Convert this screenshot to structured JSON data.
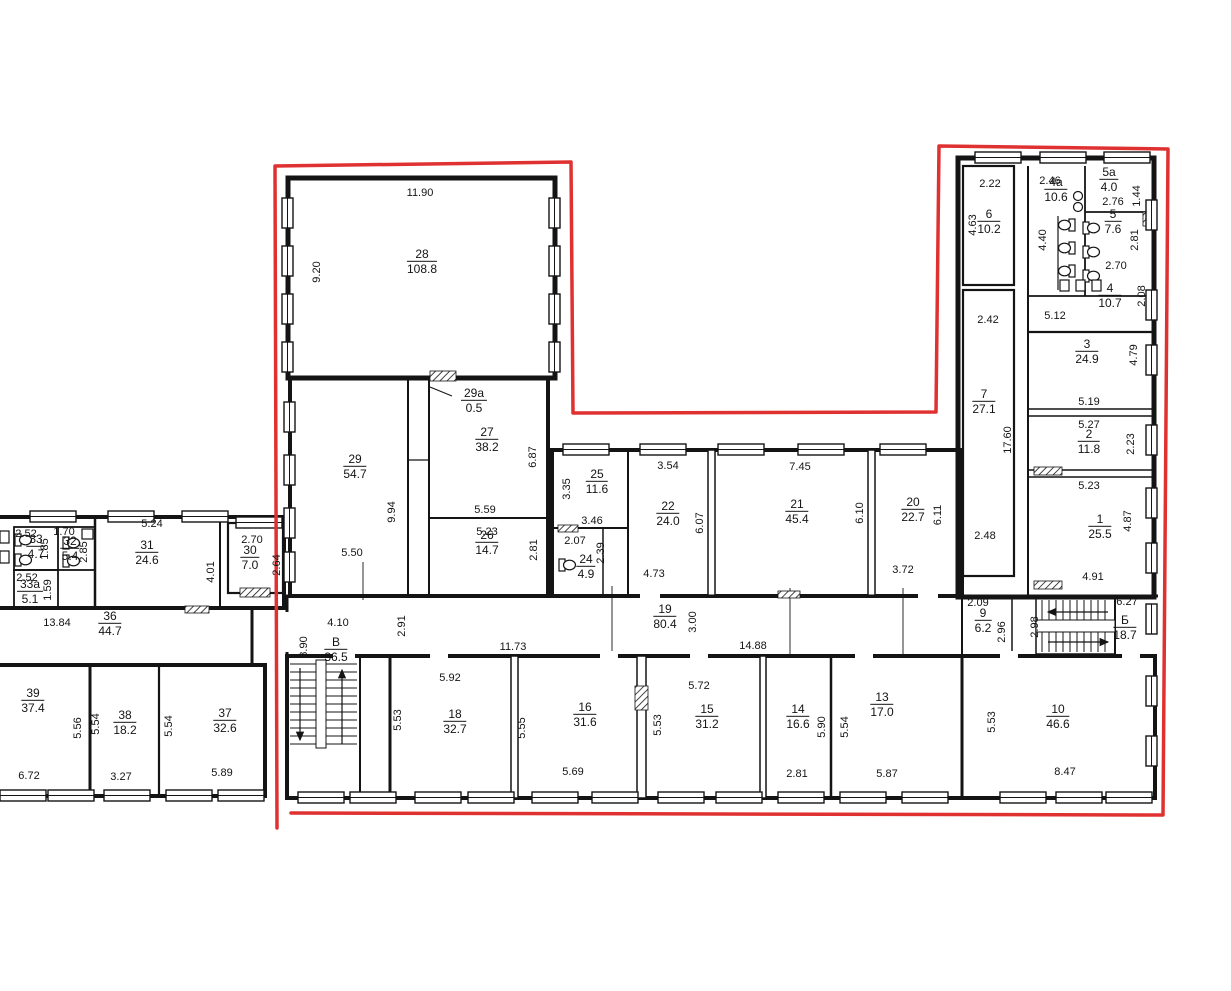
{
  "colors": {
    "outline": "#e03131",
    "wall": "#141414"
  },
  "rooms": [
    {
      "number": "28",
      "area": "108.8",
      "cx": 422,
      "cy": 262
    },
    {
      "number": "29a",
      "area": "0.5",
      "cx": 474,
      "cy": 401
    },
    {
      "number": "29",
      "area": "54.7",
      "cx": 355,
      "cy": 467
    },
    {
      "number": "27",
      "area": "38.2",
      "cx": 487,
      "cy": 440
    },
    {
      "number": "26",
      "area": "14.7",
      "cx": 487,
      "cy": 543
    },
    {
      "number": "25",
      "area": "11.6",
      "cx": 597,
      "cy": 482
    },
    {
      "number": "24",
      "area": "4.9",
      "cx": 586,
      "cy": 567
    },
    {
      "number": "22",
      "area": "24.0",
      "cx": 668,
      "cy": 514
    },
    {
      "number": "21",
      "area": "45.4",
      "cx": 797,
      "cy": 512
    },
    {
      "number": "20",
      "area": "22.7",
      "cx": 913,
      "cy": 510
    },
    {
      "number": "6",
      "area": "10.2",
      "cx": 989,
      "cy": 222
    },
    {
      "number": "4a",
      "area": "10.6",
      "cx": 1056,
      "cy": 190
    },
    {
      "number": "5a",
      "area": "4.0",
      "cx": 1109,
      "cy": 180
    },
    {
      "number": "5",
      "area": "7.6",
      "cx": 1113,
      "cy": 222
    },
    {
      "number": "4",
      "area": "10.7",
      "cx": 1110,
      "cy": 296
    },
    {
      "number": "7",
      "area": "27.1",
      "cx": 984,
      "cy": 402
    },
    {
      "number": "3",
      "area": "24.9",
      "cx": 1087,
      "cy": 352
    },
    {
      "number": "2",
      "area": "11.8",
      "cx": 1089,
      "cy": 442
    },
    {
      "number": "1",
      "area": "25.5",
      "cx": 1100,
      "cy": 527
    },
    {
      "number": "31",
      "area": "24.6",
      "cx": 147,
      "cy": 553
    },
    {
      "number": "30",
      "area": "7.0",
      "cx": 250,
      "cy": 558
    },
    {
      "number": "33",
      "area": "4.7",
      "cx": 36,
      "cy": 547
    },
    {
      "number": "32",
      "area": "5.4",
      "cx": 70,
      "cy": 549
    },
    {
      "number": "33a",
      "area": "5.1",
      "cx": 30,
      "cy": 592
    },
    {
      "number": "36",
      "area": "44.7",
      "cx": 110,
      "cy": 624
    },
    {
      "number": "39",
      "area": "37.4",
      "cx": 33,
      "cy": 701
    },
    {
      "number": "38",
      "area": "18.2",
      "cx": 125,
      "cy": 723
    },
    {
      "number": "37",
      "area": "32.6",
      "cx": 225,
      "cy": 721
    },
    {
      "number": "В",
      "area": "36.5",
      "cx": 336,
      "cy": 650
    },
    {
      "number": "19",
      "area": "80.4",
      "cx": 665,
      "cy": 617
    },
    {
      "number": "9",
      "area": "6.2",
      "cx": 983,
      "cy": 621
    },
    {
      "number": "Б",
      "area": "18.7",
      "cx": 1125,
      "cy": 628
    },
    {
      "number": "18",
      "area": "32.7",
      "cx": 455,
      "cy": 722
    },
    {
      "number": "16",
      "area": "31.6",
      "cx": 585,
      "cy": 715
    },
    {
      "number": "15",
      "area": "31.2",
      "cx": 707,
      "cy": 717
    },
    {
      "number": "14",
      "area": "16.6",
      "cx": 798,
      "cy": 717
    },
    {
      "number": "13",
      "area": "17.0",
      "cx": 882,
      "cy": 705
    },
    {
      "number": "10",
      "area": "46.6",
      "cx": 1058,
      "cy": 717
    }
  ],
  "dimensions": [
    {
      "text": "11.90",
      "cx": 420,
      "cy": 193
    },
    {
      "text": "9.20",
      "cx": 317,
      "cy": 272,
      "v": true
    },
    {
      "text": "9.94",
      "cx": 392,
      "cy": 512,
      "v": true
    },
    {
      "text": "5.50",
      "cx": 352,
      "cy": 553
    },
    {
      "text": "6.87",
      "cx": 533,
      "cy": 457,
      "v": true
    },
    {
      "text": "5.59",
      "cx": 485,
      "cy": 510
    },
    {
      "text": "5.23",
      "cx": 487,
      "cy": 532
    },
    {
      "text": "2.81",
      "cx": 534,
      "cy": 550,
      "v": true
    },
    {
      "text": "3.35",
      "cx": 567,
      "cy": 489,
      "v": true
    },
    {
      "text": "3.46",
      "cx": 592,
      "cy": 521
    },
    {
      "text": "2.07",
      "cx": 575,
      "cy": 541
    },
    {
      "text": "2.39",
      "cx": 601,
      "cy": 553,
      "v": true
    },
    {
      "text": "3.54",
      "cx": 668,
      "cy": 466
    },
    {
      "text": "6.07",
      "cx": 700,
      "cy": 523,
      "v": true
    },
    {
      "text": "4.73",
      "cx": 654,
      "cy": 574
    },
    {
      "text": "7.45",
      "cx": 800,
      "cy": 467
    },
    {
      "text": "6.10",
      "cx": 860,
      "cy": 513,
      "v": true
    },
    {
      "text": "6.11",
      "cx": 938,
      "cy": 515,
      "v": true
    },
    {
      "text": "3.72",
      "cx": 903,
      "cy": 570
    },
    {
      "text": "2.22",
      "cx": 990,
      "cy": 184
    },
    {
      "text": "4.63",
      "cx": 973,
      "cy": 225,
      "v": true
    },
    {
      "text": "2.46",
      "cx": 1050,
      "cy": 181
    },
    {
      "text": "4.40",
      "cx": 1043,
      "cy": 240,
      "v": true
    },
    {
      "text": "2.76",
      "cx": 1113,
      "cy": 202
    },
    {
      "text": "1.44",
      "cx": 1137,
      "cy": 196,
      "v": true
    },
    {
      "text": "2.81",
      "cx": 1135,
      "cy": 240,
      "v": true
    },
    {
      "text": "2.70",
      "cx": 1116,
      "cy": 266
    },
    {
      "text": "5.12",
      "cx": 1055,
      "cy": 316
    },
    {
      "text": "2.08",
      "cx": 1142,
      "cy": 296,
      "v": true
    },
    {
      "text": "2.42",
      "cx": 988,
      "cy": 320
    },
    {
      "text": "17.60",
      "cx": 1008,
      "cy": 440,
      "v": true
    },
    {
      "text": "2.48",
      "cx": 985,
      "cy": 536
    },
    {
      "text": "4.79",
      "cx": 1134,
      "cy": 355,
      "v": true
    },
    {
      "text": "5.19",
      "cx": 1089,
      "cy": 402
    },
    {
      "text": "5.27",
      "cx": 1089,
      "cy": 425
    },
    {
      "text": "2.23",
      "cx": 1131,
      "cy": 444,
      "v": true
    },
    {
      "text": "5.23",
      "cx": 1089,
      "cy": 486
    },
    {
      "text": "4.87",
      "cx": 1128,
      "cy": 521,
      "v": true
    },
    {
      "text": "4.91",
      "cx": 1093,
      "cy": 577
    },
    {
      "text": "5.24",
      "cx": 152,
      "cy": 524
    },
    {
      "text": "4.01",
      "cx": 211,
      "cy": 572,
      "v": true
    },
    {
      "text": "2.70",
      "cx": 252,
      "cy": 540
    },
    {
      "text": "2.64",
      "cx": 277,
      "cy": 565,
      "v": true
    },
    {
      "text": "2.52",
      "cx": 26,
      "cy": 534
    },
    {
      "text": "1.85",
      "cx": 45,
      "cy": 549,
      "v": true
    },
    {
      "text": "1.70",
      "cx": 64,
      "cy": 532
    },
    {
      "text": "2.85",
      "cx": 84,
      "cy": 552,
      "v": true
    },
    {
      "text": "2.52",
      "cx": 27,
      "cy": 578
    },
    {
      "text": "1.59",
      "cx": 48,
      "cy": 590,
      "v": true
    },
    {
      "text": "13.84",
      "cx": 57,
      "cy": 623
    },
    {
      "text": "5.56",
      "cx": 78,
      "cy": 728,
      "v": true
    },
    {
      "text": "6.72",
      "cx": 29,
      "cy": 776
    },
    {
      "text": "5.54",
      "cx": 96,
      "cy": 724,
      "v": true
    },
    {
      "text": "3.27",
      "cx": 121,
      "cy": 777
    },
    {
      "text": "5.54",
      "cx": 169,
      "cy": 726,
      "v": true
    },
    {
      "text": "5.89",
      "cx": 222,
      "cy": 773
    },
    {
      "text": "4.10",
      "cx": 338,
      "cy": 623
    },
    {
      "text": "8.90",
      "cx": 304,
      "cy": 647,
      "v": true
    },
    {
      "text": "2.91",
      "cx": 402,
      "cy": 626,
      "v": true
    },
    {
      "text": "11.73",
      "cx": 513,
      "cy": 647
    },
    {
      "text": "3.00",
      "cx": 693,
      "cy": 622,
      "v": true
    },
    {
      "text": "5.92",
      "cx": 450,
      "cy": 678
    },
    {
      "text": "5.53",
      "cx": 398,
      "cy": 720,
      "v": true
    },
    {
      "text": "5.55",
      "cx": 522,
      "cy": 728,
      "v": true
    },
    {
      "text": "5.69",
      "cx": 573,
      "cy": 772
    },
    {
      "text": "14.88",
      "cx": 753,
      "cy": 646
    },
    {
      "text": "5.72",
      "cx": 699,
      "cy": 686
    },
    {
      "text": "5.53",
      "cx": 658,
      "cy": 725,
      "v": true
    },
    {
      "text": "5.90",
      "cx": 822,
      "cy": 727,
      "v": true
    },
    {
      "text": "2.81",
      "cx": 797,
      "cy": 774
    },
    {
      "text": "5.54",
      "cx": 845,
      "cy": 727,
      "v": true
    },
    {
      "text": "5.87",
      "cx": 887,
      "cy": 774
    },
    {
      "text": "2.09",
      "cx": 978,
      "cy": 603
    },
    {
      "text": "2.96",
      "cx": 1002,
      "cy": 632,
      "v": true
    },
    {
      "text": "2.98",
      "cx": 1035,
      "cy": 627,
      "v": true
    },
    {
      "text": "6.27",
      "cx": 1127,
      "cy": 602
    },
    {
      "text": "5.53",
      "cx": 992,
      "cy": 722,
      "v": true
    },
    {
      "text": "8.47",
      "cx": 1065,
      "cy": 772
    }
  ]
}
